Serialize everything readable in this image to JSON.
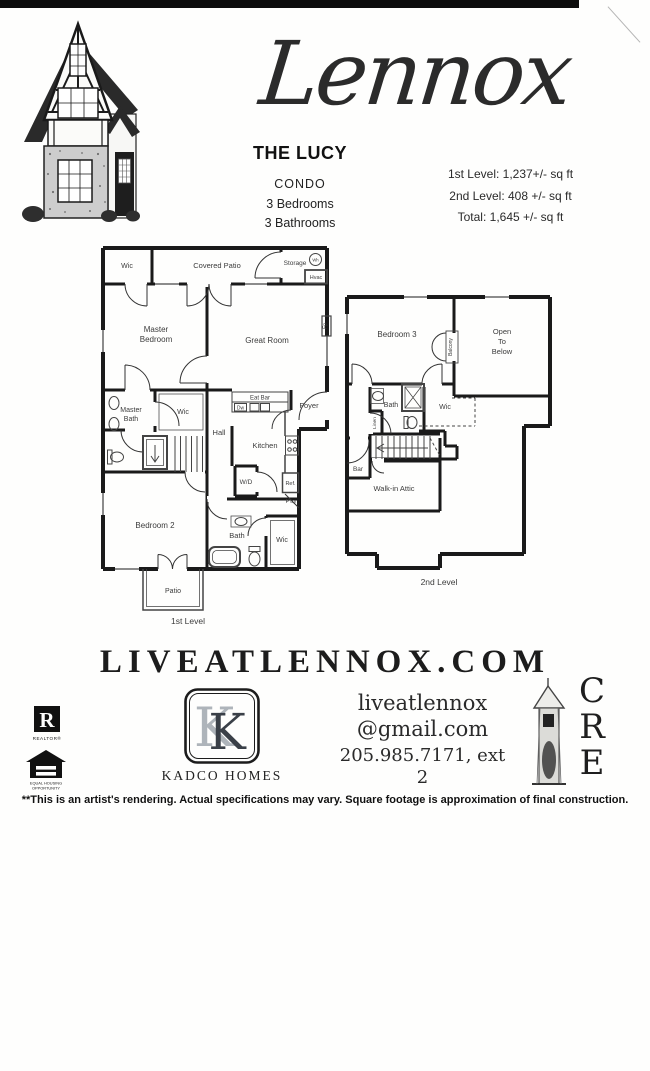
{
  "page": {
    "title_script": "Lennox",
    "plan_name": "THE LUCY",
    "property_type": "CONDO",
    "bedrooms": "3 Bedrooms",
    "bathrooms": "3 Bathrooms",
    "sqft": {
      "level1": "1st Level: 1,237+/- sq ft",
      "level2": "2nd Level: 408 +/- sq ft",
      "total": "Total: 1,645 +/- sq ft"
    }
  },
  "plan1": {
    "level_label": "1st Level",
    "labels": {
      "wic_closet": "Wic",
      "covered_patio": "Covered Patio",
      "storage": "Storage",
      "water_heater": "Wh",
      "hvac": "Hvac",
      "master_bedroom": [
        "Master",
        "Bedroom"
      ],
      "great_room": "Great Room",
      "fireplace": "Fp",
      "master_bath": [
        "Master",
        "Bath"
      ],
      "wic_bath": "Wic",
      "eat_bar": "Eat Bar",
      "dishwasher": "Dw",
      "foyer": "Foyer",
      "hall": "Hall",
      "kitchen": "Kitchen",
      "washer_dryer": "W/D",
      "refrigerator": "Ref.",
      "pantry": "P'try",
      "bedroom2": "Bedroom 2",
      "bath": "Bath",
      "wic_bedroom": "Wic",
      "patio": "Patio"
    }
  },
  "plan2": {
    "level_label": "2nd Level",
    "labels": {
      "bedroom3": "Bedroom 3",
      "balcony": "Balcony",
      "open_to_below": [
        "Open",
        "To",
        "Below"
      ],
      "bath": "Bath",
      "linen": "Linen",
      "wic": "Wic",
      "bar": "Bar",
      "walk_in_attic": "Walk-in Attic"
    }
  },
  "footer": {
    "website": "LIVEATLENNOX.COM",
    "realtor_label": "REALTOR®",
    "equal_housing": [
      "EQUAL HOUSING",
      "OPPORTUNITY"
    ],
    "builder_monogram": "K",
    "builder_name": "KADCO HOMES",
    "contact": {
      "line1": "liveatlennox",
      "line2": "@gmail.com",
      "phone": "205.985.7171, ext 2"
    },
    "cre_letters": [
      "C",
      "R",
      "E"
    ],
    "disclaimer": "**This is an artist's rendering. Actual specifications may vary. Square footage is approximation of final construction."
  },
  "colors": {
    "ink": "#1a1a1a",
    "label_gray": "#3c3c3c",
    "stone_gray": "#cdcdcd",
    "monogram_light": "#aeb4ba",
    "monogram_dark": "#3a4048"
  }
}
